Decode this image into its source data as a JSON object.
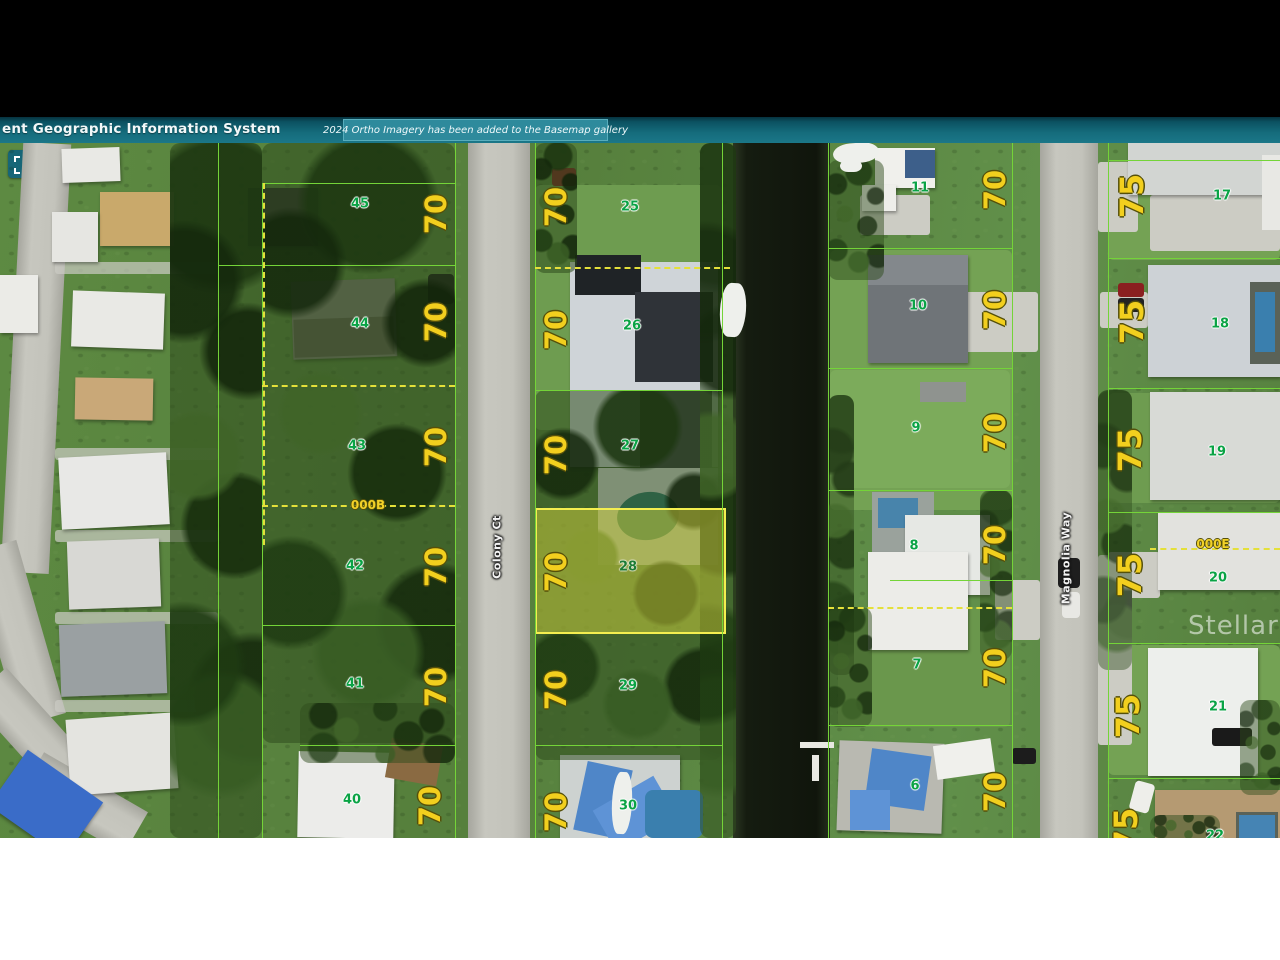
{
  "header": {
    "title": "ent Geographic Information System",
    "notification": "2024 Ortho Imagery has been added to the Basemap gallery",
    "teal_color": "#156c7c"
  },
  "toolbar": {
    "tools": [
      {
        "name": "marquee-select",
        "icon": "dashed-square-icon"
      },
      {
        "name": "edit-note",
        "icon": "note-pencil-icon"
      },
      {
        "name": "draw-measure",
        "icon": "pencil-icon"
      }
    ]
  },
  "map": {
    "highlighted_parcel": "28",
    "highlight_color": "#f4ee50",
    "parcel_line_color": "#74d438",
    "lot_line_color": "#e4e03a",
    "watermark": "Stellar MLS",
    "street_labels": [
      {
        "t": "Colony Ct",
        "x": 497,
        "y": 547
      },
      {
        "t": "Magnolia Way",
        "x": 1066,
        "y": 558
      }
    ],
    "lot_line_labels": [
      {
        "t": "000B",
        "x": 368,
        "y": 505
      },
      {
        "t": "000E",
        "x": 1213,
        "y": 544
      }
    ],
    "parcel_numbers": [
      {
        "t": "45",
        "x": 360,
        "y": 204
      },
      {
        "t": "44",
        "x": 360,
        "y": 324
      },
      {
        "t": "43",
        "x": 357,
        "y": 446
      },
      {
        "t": "42",
        "x": 355,
        "y": 566
      },
      {
        "t": "41",
        "x": 355,
        "y": 684
      },
      {
        "t": "40",
        "x": 352,
        "y": 800
      },
      {
        "t": "25",
        "x": 630,
        "y": 207
      },
      {
        "t": "26",
        "x": 632,
        "y": 326
      },
      {
        "t": "27",
        "x": 630,
        "y": 446
      },
      {
        "t": "28",
        "x": 628,
        "y": 567,
        "hl": true
      },
      {
        "t": "29",
        "x": 628,
        "y": 686
      },
      {
        "t": "30",
        "x": 628,
        "y": 806
      },
      {
        "t": "11",
        "x": 920,
        "y": 188
      },
      {
        "t": "10",
        "x": 918,
        "y": 306
      },
      {
        "t": "9",
        "x": 916,
        "y": 428
      },
      {
        "t": "8",
        "x": 914,
        "y": 546
      },
      {
        "t": "7",
        "x": 917,
        "y": 665
      },
      {
        "t": "6",
        "x": 915,
        "y": 786
      },
      {
        "t": "17",
        "x": 1222,
        "y": 196
      },
      {
        "t": "18",
        "x": 1220,
        "y": 324
      },
      {
        "t": "19",
        "x": 1217,
        "y": 452
      },
      {
        "t": "20",
        "x": 1218,
        "y": 578
      },
      {
        "t": "21",
        "x": 1218,
        "y": 707
      },
      {
        "t": "22",
        "x": 1215,
        "y": 836
      }
    ],
    "dimension_labels": [
      {
        "t": "70",
        "x": 436,
        "y": 214
      },
      {
        "t": "70",
        "x": 436,
        "y": 322
      },
      {
        "t": "70",
        "x": 436,
        "y": 447
      },
      {
        "t": "70",
        "x": 436,
        "y": 567
      },
      {
        "t": "70",
        "x": 436,
        "y": 687
      },
      {
        "t": "70",
        "x": 430,
        "y": 806
      },
      {
        "t": "70",
        "x": 556,
        "y": 207
      },
      {
        "t": "70",
        "x": 556,
        "y": 330
      },
      {
        "t": "70",
        "x": 556,
        "y": 455
      },
      {
        "t": "70",
        "x": 556,
        "y": 572
      },
      {
        "t": "70",
        "x": 556,
        "y": 690
      },
      {
        "t": "70",
        "x": 556,
        "y": 812
      },
      {
        "t": "70",
        "x": 995,
        "y": 190
      },
      {
        "t": "70",
        "x": 995,
        "y": 310
      },
      {
        "t": "70",
        "x": 995,
        "y": 433
      },
      {
        "t": "70",
        "x": 995,
        "y": 545
      },
      {
        "t": "70",
        "x": 995,
        "y": 668
      },
      {
        "t": "70",
        "x": 995,
        "y": 792
      },
      {
        "t": "75",
        "x": 1132,
        "y": 196,
        "s": 32
      },
      {
        "t": "75",
        "x": 1132,
        "y": 322,
        "s": 32
      },
      {
        "t": "75",
        "x": 1130,
        "y": 450,
        "s": 32
      },
      {
        "t": "75",
        "x": 1130,
        "y": 575,
        "s": 32
      },
      {
        "t": "75",
        "x": 1128,
        "y": 716,
        "s": 32
      },
      {
        "t": "75",
        "x": 1126,
        "y": 830,
        "s": 32
      }
    ]
  }
}
